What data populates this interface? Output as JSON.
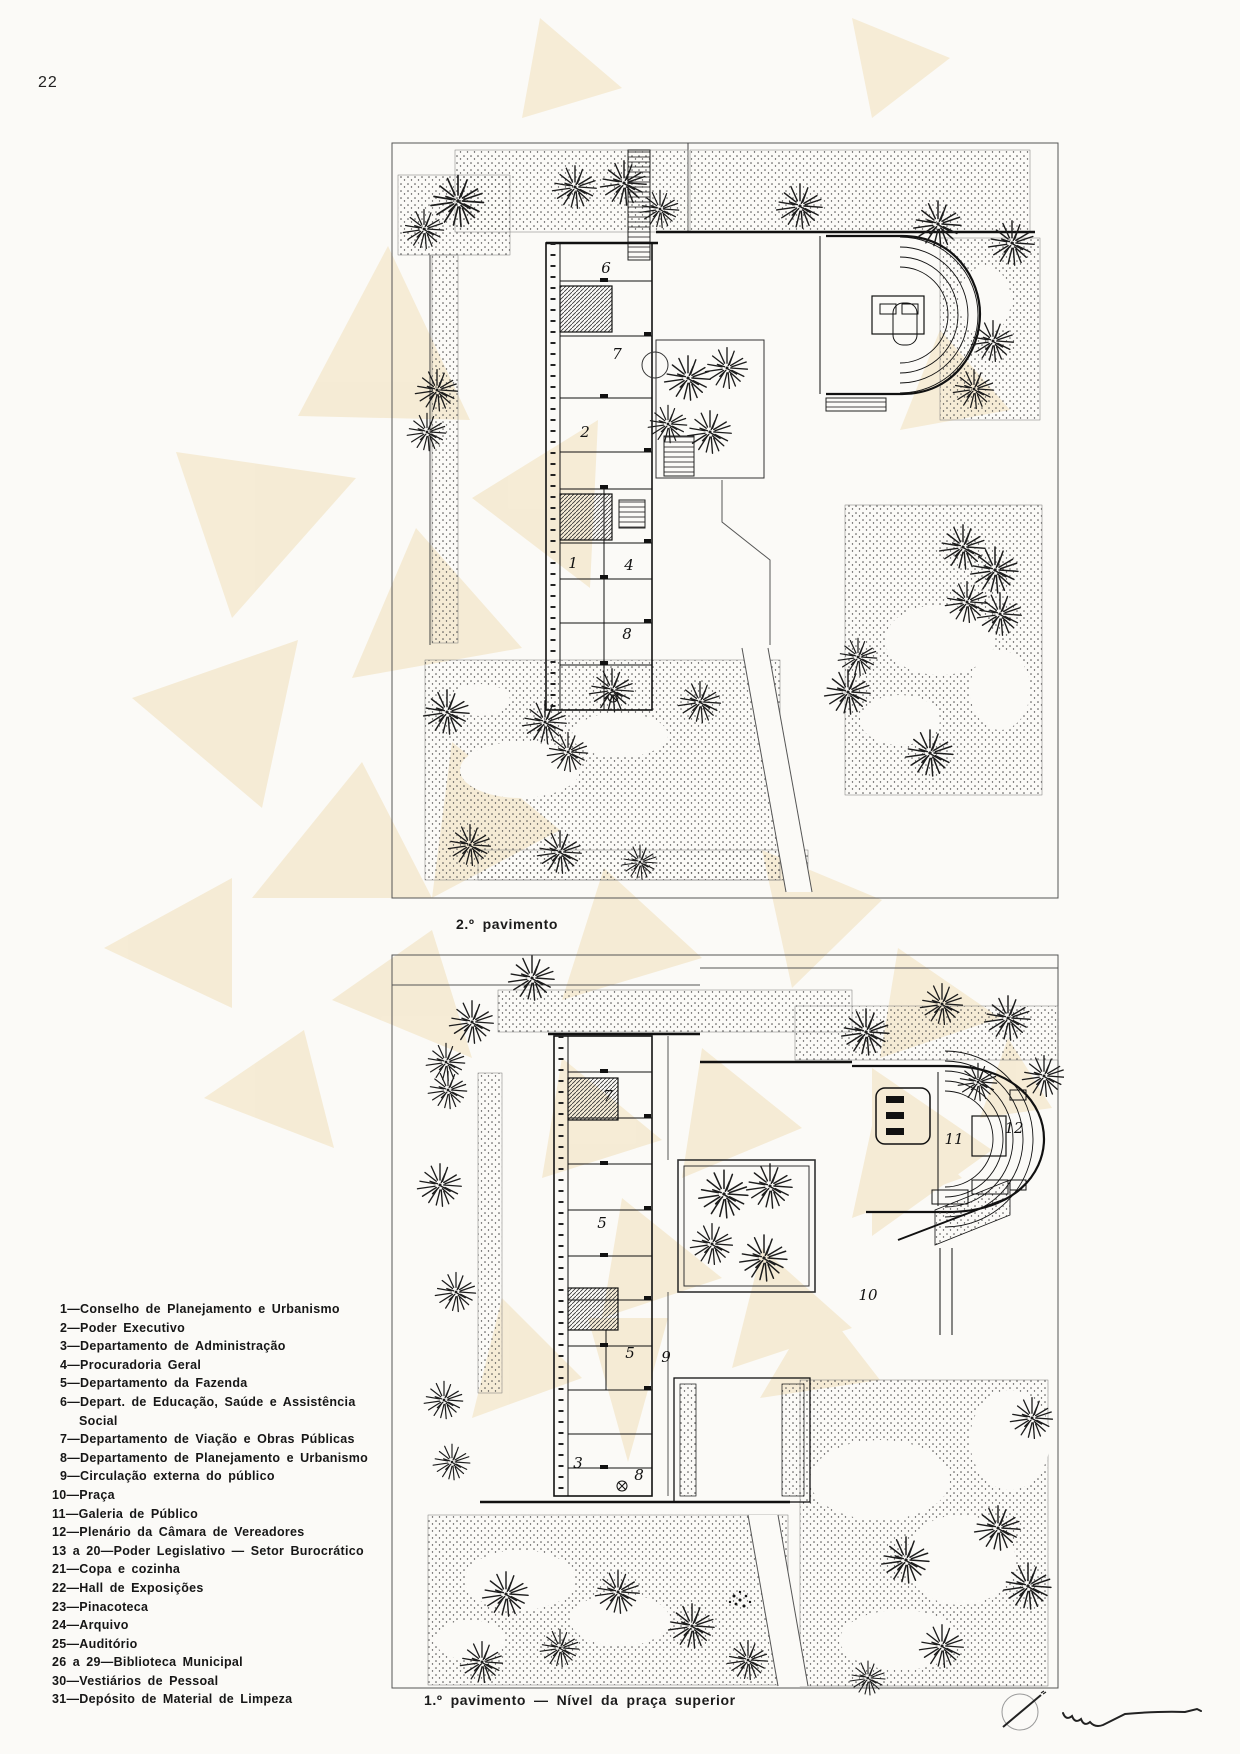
{
  "page": {
    "number": "22",
    "type": "architecture-book-floor-plans"
  },
  "colors": {
    "paper": "#fbfaf7",
    "watermark_cream": "#f5ead2",
    "ink": "#1f1f1f"
  },
  "captions": {
    "plan1": "2.º pavimento",
    "plan2": "1.º pavimento — Nível da praça superior"
  },
  "plan1": {
    "labels": [
      "6",
      "7",
      "2",
      "1",
      "4",
      "8"
    ]
  },
  "plan2": {
    "labels": [
      "7",
      "5",
      "5",
      "9",
      "3",
      "8",
      "11",
      "12",
      "10"
    ]
  },
  "legend": {
    "items": [
      {
        "text": "1—Conselho de Planejamento e Urbanismo"
      },
      {
        "text": "2—Poder Executivo"
      },
      {
        "text": "3—Departamento de Administração"
      },
      {
        "text": "4—Procuradoria Geral"
      },
      {
        "text": "5—Departamento da Fazenda"
      },
      {
        "text": "6—Depart. de Educação, Saúde e Assistência",
        "text2": "Social"
      },
      {
        "text": "7—Departamento de Viação e Obras Públicas"
      },
      {
        "text": "8—Departamento de Planejamento e Urbanismo"
      },
      {
        "text": "9—Circulação externa do público"
      },
      {
        "text": "10—Praça"
      },
      {
        "text": "11—Galeria de Público"
      },
      {
        "text": "12—Plenário da Câmara de Vereadores"
      },
      {
        "text": "13 a 20—Poder Legislativo — Setor Burocrático"
      },
      {
        "text": "21—Copa e cozinha"
      },
      {
        "text": "22—Hall de Exposições"
      },
      {
        "text": "23—Pinacoteca"
      },
      {
        "text": "24—Arquivo"
      },
      {
        "text": "25—Auditório"
      },
      {
        "text": "26 a 29—Biblioteca Municipal"
      },
      {
        "text": "30—Vestiários de Pessoal"
      },
      {
        "text": "31—Depósito de Material de Limpeza"
      }
    ]
  }
}
